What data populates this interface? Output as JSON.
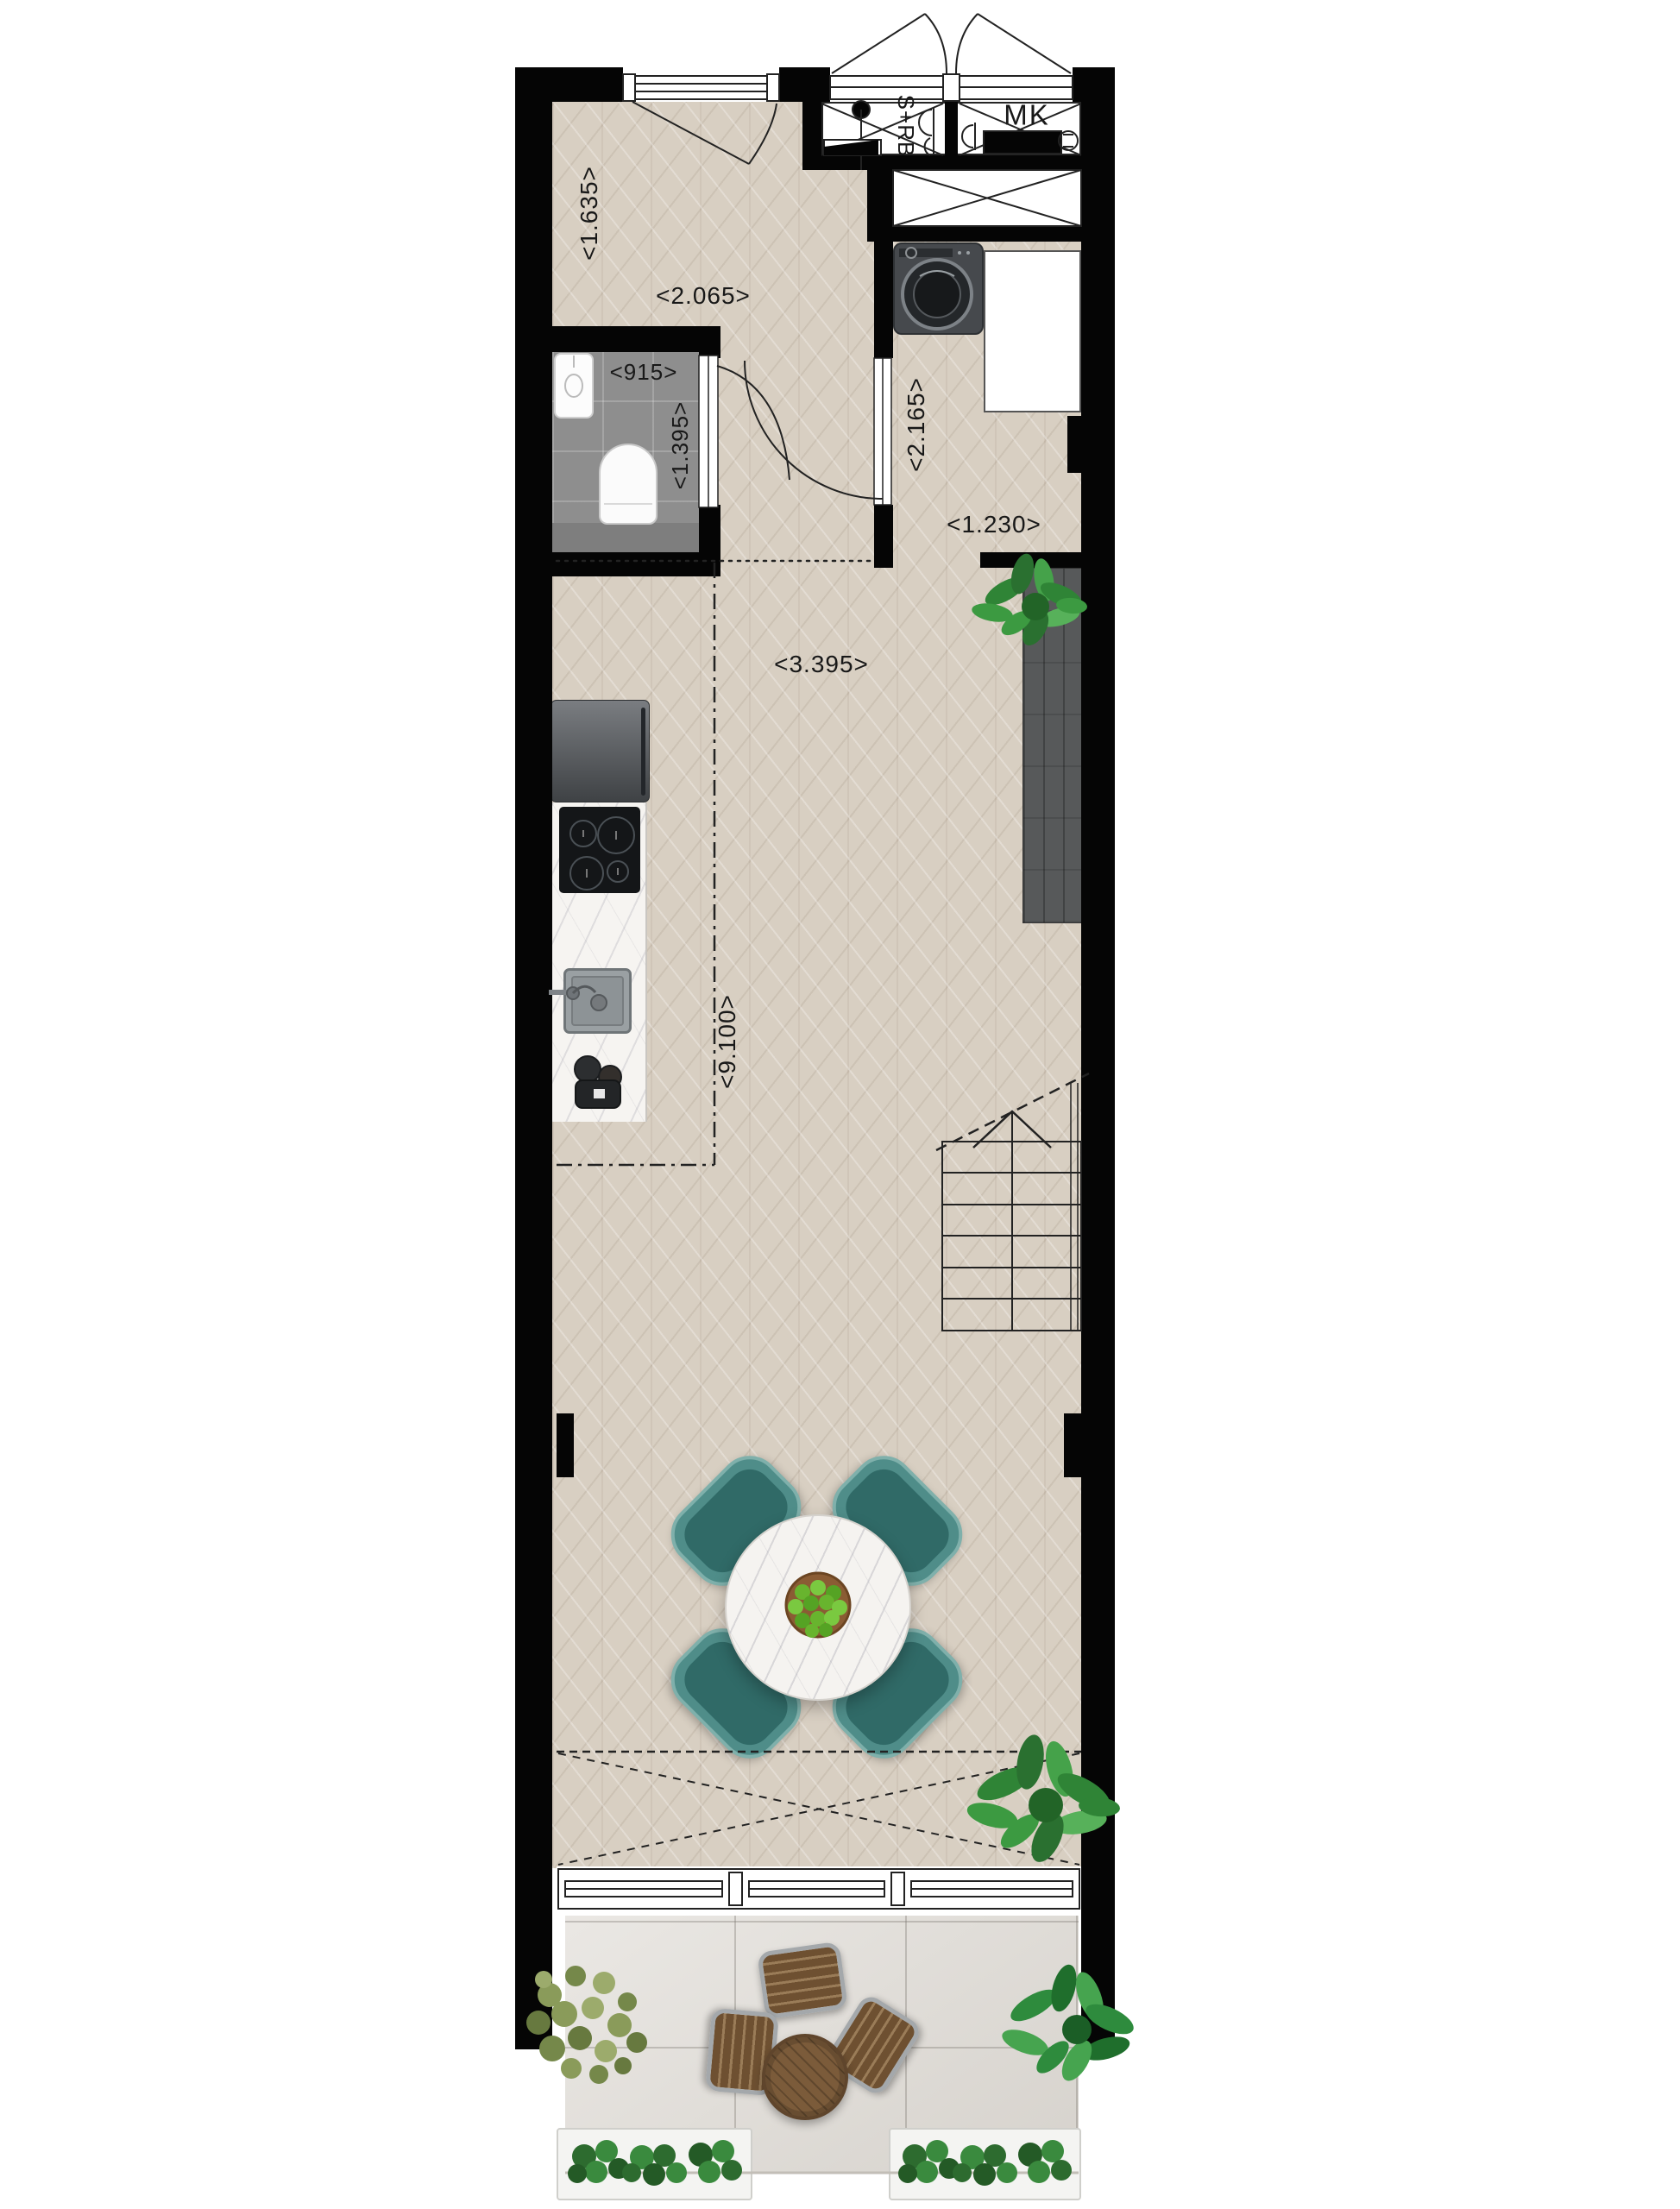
{
  "plan": {
    "labels": {
      "shaft": "S+RB",
      "meter_cupboard": "MK"
    },
    "dimensions": {
      "hall_width": "<1.635>",
      "hall_depth": "<2.065>",
      "toilet_width": "<915>",
      "toilet_depth": "<1.395>",
      "laundry_depth": "<2.165>",
      "laundry_width": "<1.230>",
      "living_width": "<3.395>",
      "living_depth": "<9.100>"
    },
    "colors": {
      "wall": "#050505",
      "parquet_floor": "#d8cfc2",
      "bathroom_tile": "#8e8e8e",
      "terrace_tile": "#dfdbd5",
      "cabinet_wood": "#57595a",
      "dining_chair_teal": "#4f8d89",
      "plant_green": "#3c9a41",
      "outdoor_furniture_wood": "#7b5b3a"
    }
  }
}
